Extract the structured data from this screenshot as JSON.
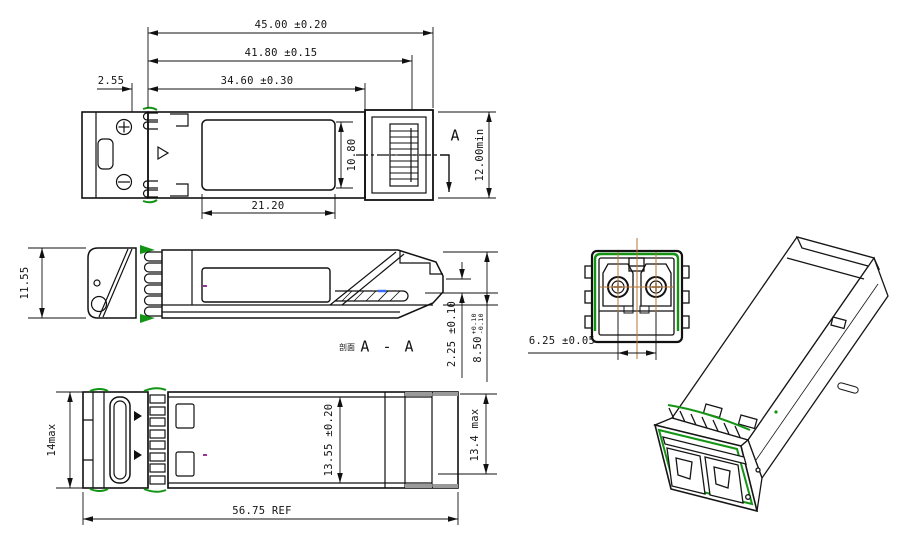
{
  "drawing": {
    "colors": {
      "line": "#111111",
      "accent_green": "#149414",
      "centerline_orange": "#b87333",
      "pcb_blue": "#3a6bff",
      "mark_purple": "#993399",
      "shade_grey": "#9a9a9a",
      "background": "#ffffff"
    },
    "top_view": {
      "dim_overall_length": "45.00 ±0.20",
      "dim_pad_length": "41.80 ±0.15",
      "dim_body_length": "34.60 ±0.30",
      "dim_bezel_offset": "2.55",
      "dim_label_width": "21.20",
      "dim_label_height": "10.80",
      "dim_min_height": "12.00min",
      "section_marker": "A"
    },
    "side_view": {
      "dim_height": "11.55",
      "dim_pcb_offset": "2.25 ±0.10",
      "dim_body_height": "8.50",
      "dim_body_height_tol_upper": "+0.10",
      "dim_body_height_tol_lower": "-0.10",
      "section_label_prefix": "剖面",
      "section_label": "A - A"
    },
    "bottom_view": {
      "dim_front_width": "14max",
      "dim_body_width": "13.55 ±0.20",
      "dim_rear_width": "13.4 max",
      "dim_overall_length_ref": "56.75 REF"
    },
    "front_view": {
      "dim_port_pitch": "6.25 ±0.05"
    }
  }
}
